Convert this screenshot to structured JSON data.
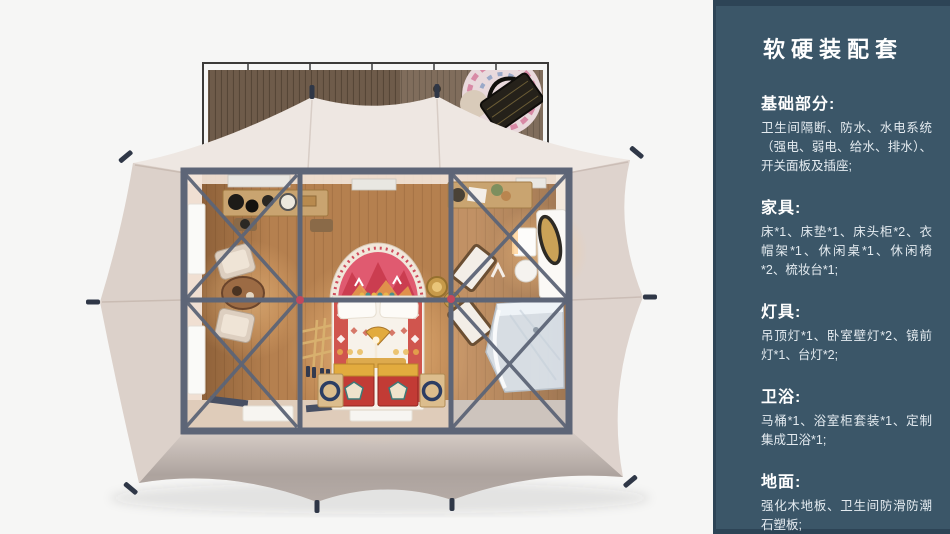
{
  "sidebar": {
    "title": "软硬装配套",
    "sections": [
      {
        "heading": "基础部分:",
        "body": "卫生间隔断、防水、水电系统（强电、弱电、给水、排水）、开关面板及插座;"
      },
      {
        "heading": "家具:",
        "body": "床*1、床垫*1、床头柜*2、衣帽架*1、休闲桌*1、休闲椅*2、梳妆台*1;"
      },
      {
        "heading": "灯具:",
        "body": "吊顶灯*1、卧室壁灯*2、镜前灯*1、台灯*2;"
      },
      {
        "heading": "卫浴:",
        "body": "马桶*1、浴室柜套装*1、定制集成卫浴*1;"
      },
      {
        "heading": "地面:",
        "body": "强化木地板、卫生间防滑防潮石塑板;"
      }
    ]
  },
  "scene": {
    "type": "top-view 3D render of furnished glamping tent with front deck",
    "colors": {
      "background": "#f6f6f5",
      "sidebar_bg": "#3b5668",
      "sidebar_edge": "#2d4456",
      "tent_canvas": "#e8ded7",
      "tent_shade": "#b3a9a4",
      "deck_wood": "#6e5b4a",
      "deck_rail": "#3c3a38",
      "frame_beam": "#5d6577",
      "frame_joint": "#c2485c",
      "floor_wood": "#b5804f",
      "wall_cream": "#f0dfd2",
      "glow_warm": "#ffbe76",
      "bed_linen": "#f7f2ea",
      "bed_pattern_red": "#cc4840",
      "rug_pink": "#e05a70",
      "gold_accent": "#e2ab3e",
      "chest_red": "#c23b35",
      "shower_glass": "#d9e1e9",
      "chair_fabric": "#ddcfc0",
      "wood_furniture": "#c9a470"
    }
  }
}
